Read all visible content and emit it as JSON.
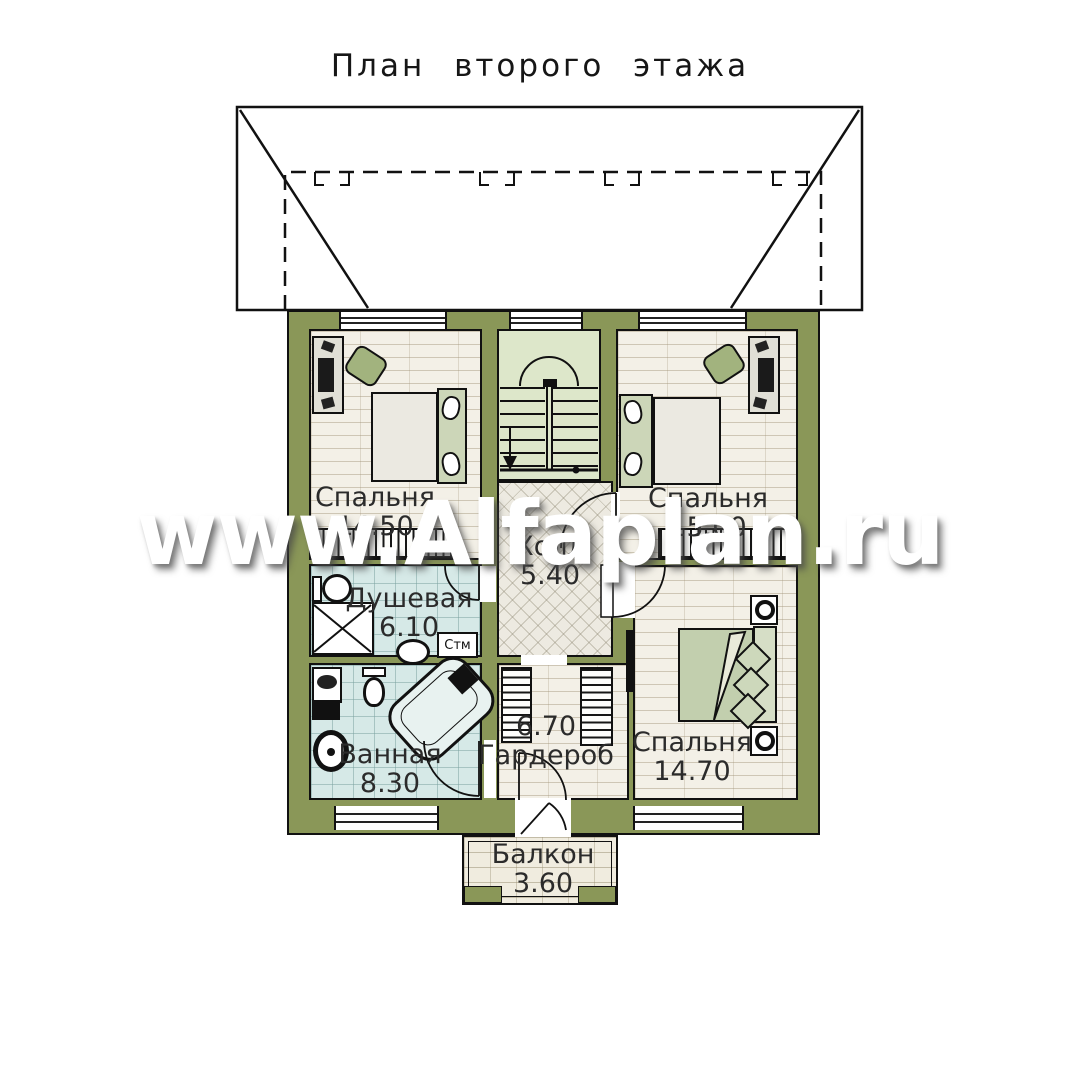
{
  "page": {
    "title": "План второго этажа",
    "watermark": "www.Alfaplan.ru"
  },
  "rooms": [
    {
      "name": "Спальня",
      "area": "14.50"
    },
    {
      "name": "Спальня",
      "area": "15.00"
    },
    {
      "name": "Холл",
      "area": "5.40"
    },
    {
      "name": "Душевая",
      "area": "6.10"
    },
    {
      "name": "Ванная",
      "area": "8.30"
    },
    {
      "name": "Гардероб",
      "area": "6.70"
    },
    {
      "name": "Спальня",
      "area": "14.70"
    },
    {
      "name": "Балкон",
      "area": "3.60"
    }
  ],
  "labels": {
    "washing_machine": "Стм"
  },
  "colors": {
    "wall": "#8a9758",
    "stair_floor": "#dde7ca",
    "wood_floor": "#f3f0e7",
    "tile_floor": "#d6e9e7",
    "hall_floor": "#edeae1",
    "balcony_floor": "#f0ecdf",
    "line": "#111111",
    "watermark_text": "#ffffff"
  }
}
